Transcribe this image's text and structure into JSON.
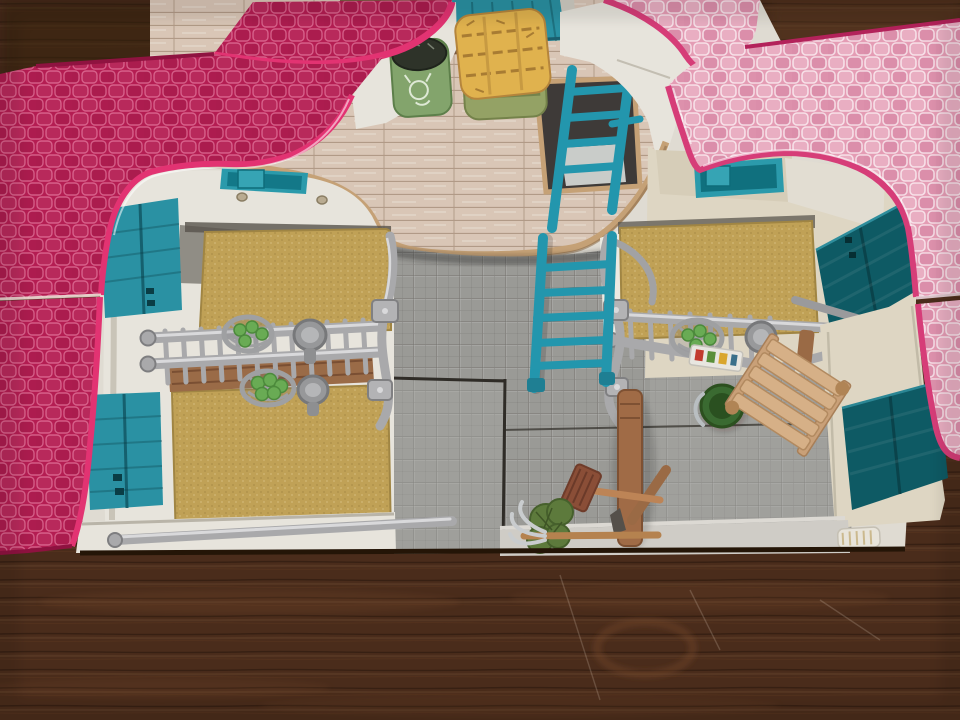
{
  "scene": {
    "description": "Top-down photo of an open toy horse stable playset with pink shingled roof wings, teal doors and windows, a wooden hayloft with hay bales and a feed sack, a teal ladder, two straw-matted stalls with metal divider rails, hay racks with green apples, a tiled courtyard with a hitching post, broom, pitchfork, feed bucket and wooden bench, all standing on a dark wooden table",
    "objects": [
      {
        "name": "wooden-table",
        "label": "dark wooden table surface"
      },
      {
        "name": "left-roof-panel",
        "label": "crimson shingled roof wing, left"
      },
      {
        "name": "right-roof-panel",
        "label": "light pink shingled roof wing, right"
      },
      {
        "name": "hayloft-floor",
        "label": "wood plank hayloft floor"
      },
      {
        "name": "loft-hatch",
        "label": "hatch opening in hayloft"
      },
      {
        "name": "teal-ladder",
        "label": "teal wooden ladder"
      },
      {
        "name": "feed-sack",
        "label": "green feed sack with animal print"
      },
      {
        "name": "straw-bale-yellow",
        "label": "yellow straw bale"
      },
      {
        "name": "straw-bale-green",
        "label": "green hay bale"
      },
      {
        "name": "stall-mats",
        "label": "tan straw stall mats"
      },
      {
        "name": "stall-divider-rails",
        "label": "grey metal stall divider rails"
      },
      {
        "name": "hay-rack-apples",
        "label": "hay racks holding green apples"
      },
      {
        "name": "feed-troughs",
        "label": "round grey feed troughs"
      },
      {
        "name": "teal-doors",
        "label": "teal stable doors and shutters"
      },
      {
        "name": "skylight-windows",
        "label": "teal skylight windows"
      },
      {
        "name": "tiled-floor",
        "label": "grey tiled courtyard floor"
      },
      {
        "name": "hitching-post",
        "label": "brown wooden hitching post"
      },
      {
        "name": "broom",
        "label": "broom with brown head"
      },
      {
        "name": "pitchfork",
        "label": "pitchfork with hay clump"
      },
      {
        "name": "feed-bucket",
        "label": "green feed bucket"
      },
      {
        "name": "grooming-bench",
        "label": "light wooden grooming bench"
      },
      {
        "name": "front-rail",
        "label": "grey metal front rail"
      }
    ]
  },
  "colors": {
    "table_wood": "#4a2c1b",
    "table_wood_dark": "#36200f",
    "table_wood_light": "#7b4e2e",
    "roof_left": "#b41d52",
    "roof_left_deep": "#8f1340",
    "roof_edge": "#e23372",
    "roof_right": "#e49cb4",
    "roof_right_edge": "#d63d78",
    "wall_white": "#e7e4dc",
    "wall_shadow": "#b9b4a8",
    "wall_cream": "#ded6c3",
    "teal_door": "#2a91a3",
    "teal_dark": "#0e5a64",
    "teal_window": "#2b9aab",
    "ladder_teal": "#2396ad",
    "loft_wood": "#d9c6b6",
    "loft_rim": "#c5a176",
    "mat_tan": "#c0a156",
    "floor_gray": "#9a9a96",
    "floor_gray_light": "#adada8",
    "seam_dark": "#2f2c27",
    "metal": "#a9a9ab",
    "metal_dark": "#77777a",
    "metal_light": "#d9d9db",
    "apple_green": "#69ab54",
    "hay_yellow": "#e0b24e",
    "hay_groove": "#a87c33",
    "bale_green": "#94a265",
    "sack_green": "#83a46c",
    "sack_top": "#2e3329",
    "bucket_green": "#3a6a31",
    "wood_post": "#a06b46",
    "wood_bench": "#d6b087",
    "broom_head": "#8a4e37",
    "plant_green": "#5d7a3c",
    "brown_partition": "#9a6b47"
  }
}
